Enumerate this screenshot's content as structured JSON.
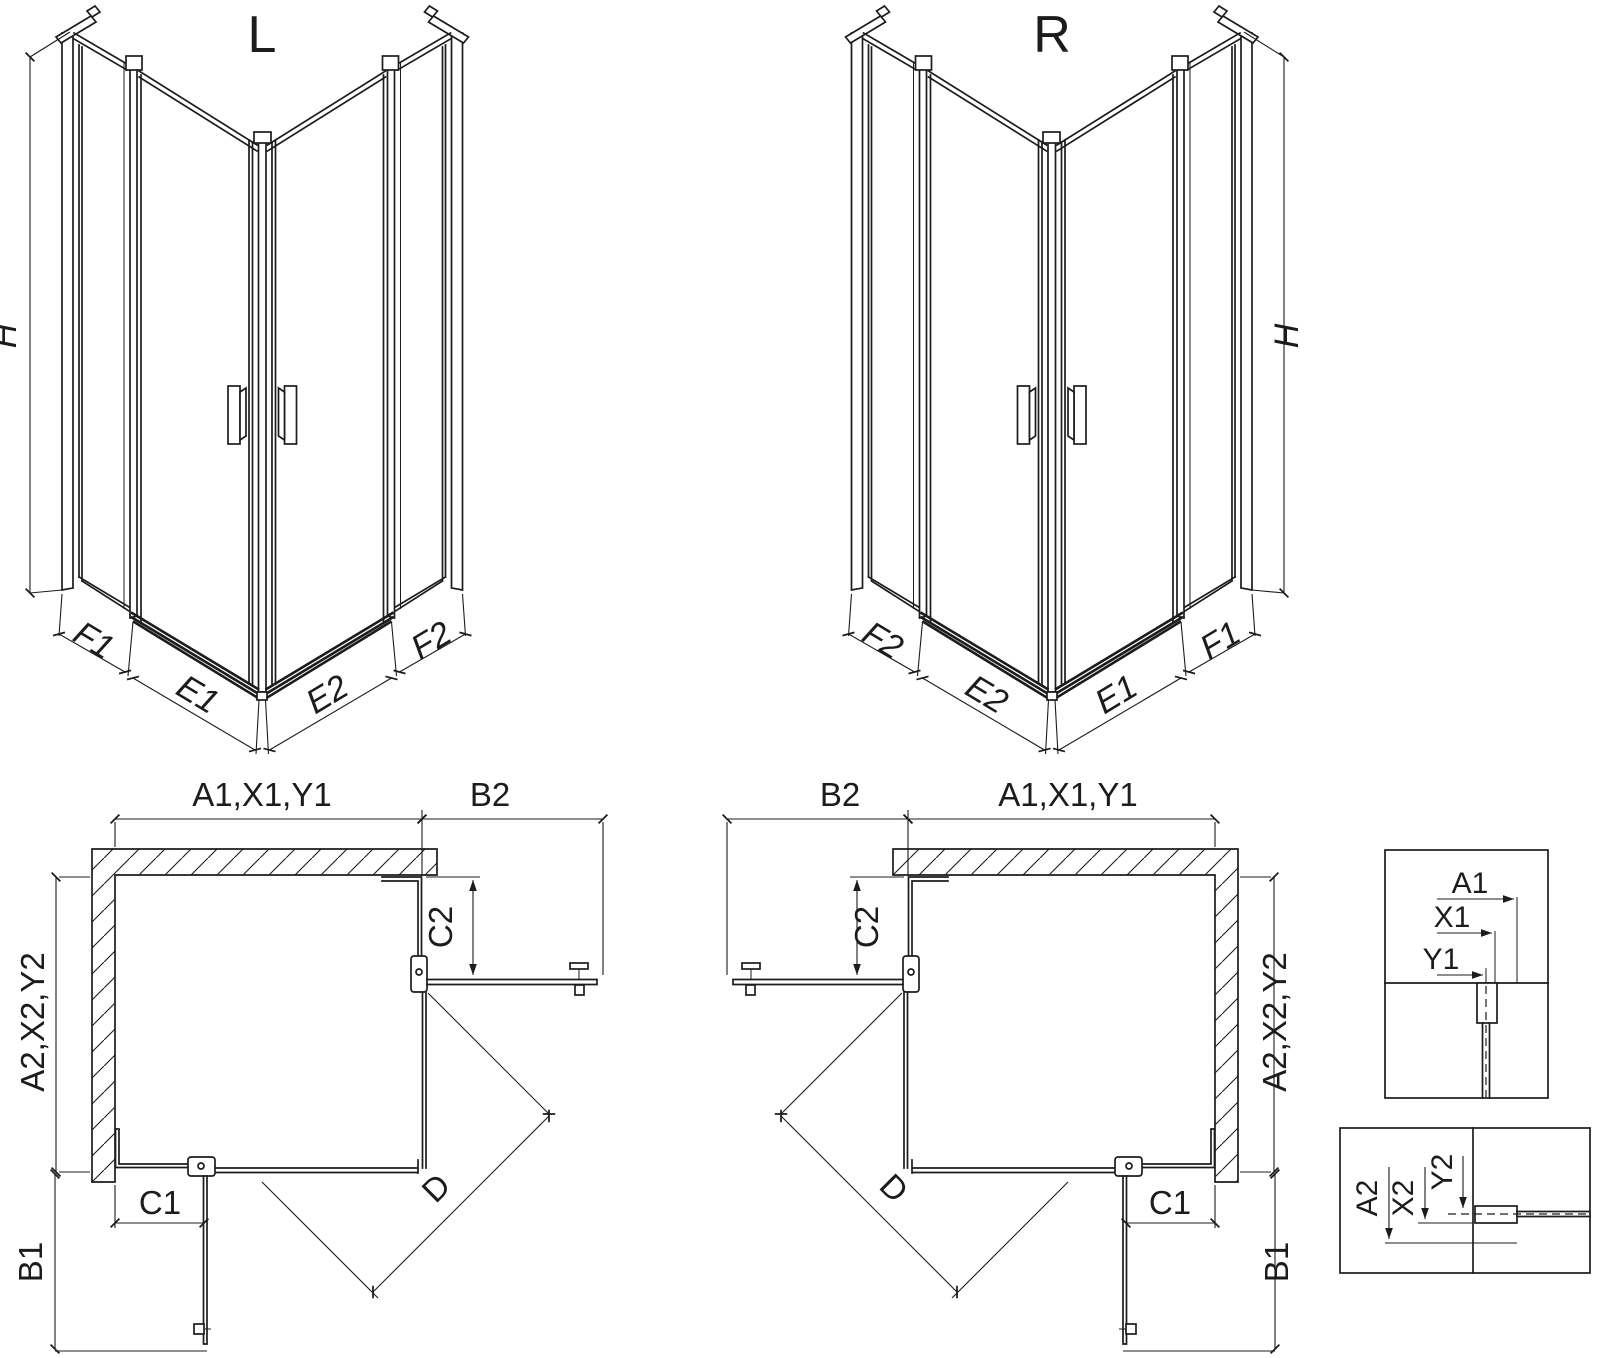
{
  "drawing": {
    "colors": {
      "line": "#1c1c1c",
      "background": "#ffffff"
    },
    "views": {
      "iso_left": {
        "title": "L",
        "dims": {
          "h": "H",
          "f1": "F1",
          "e1": "E1",
          "e2": "E2",
          "f2": "F2"
        }
      },
      "iso_right": {
        "title": "R",
        "dims": {
          "h": "H",
          "f1": "F1",
          "e1": "E1",
          "e2": "E2",
          "f2": "F2"
        }
      },
      "plan_left": {
        "dims": {
          "top": "A1,X1,Y1",
          "b2": "B2",
          "c2": "C2",
          "side": "A2,X2,Y2",
          "c1": "C1",
          "b1": "B1",
          "d": "D"
        }
      },
      "plan_right": {
        "dims": {
          "top": "A1,X1,Y1",
          "b2": "B2",
          "c2": "C2",
          "side": "A2,X2,Y2",
          "c1": "C1",
          "b1": "B1",
          "d": "D"
        }
      },
      "detail_top": {
        "dims": {
          "a1": "A1",
          "x1": "X1",
          "y1": "Y1"
        }
      },
      "detail_bottom": {
        "dims": {
          "a2": "A2",
          "x2": "X2",
          "y2": "Y2"
        }
      }
    }
  }
}
